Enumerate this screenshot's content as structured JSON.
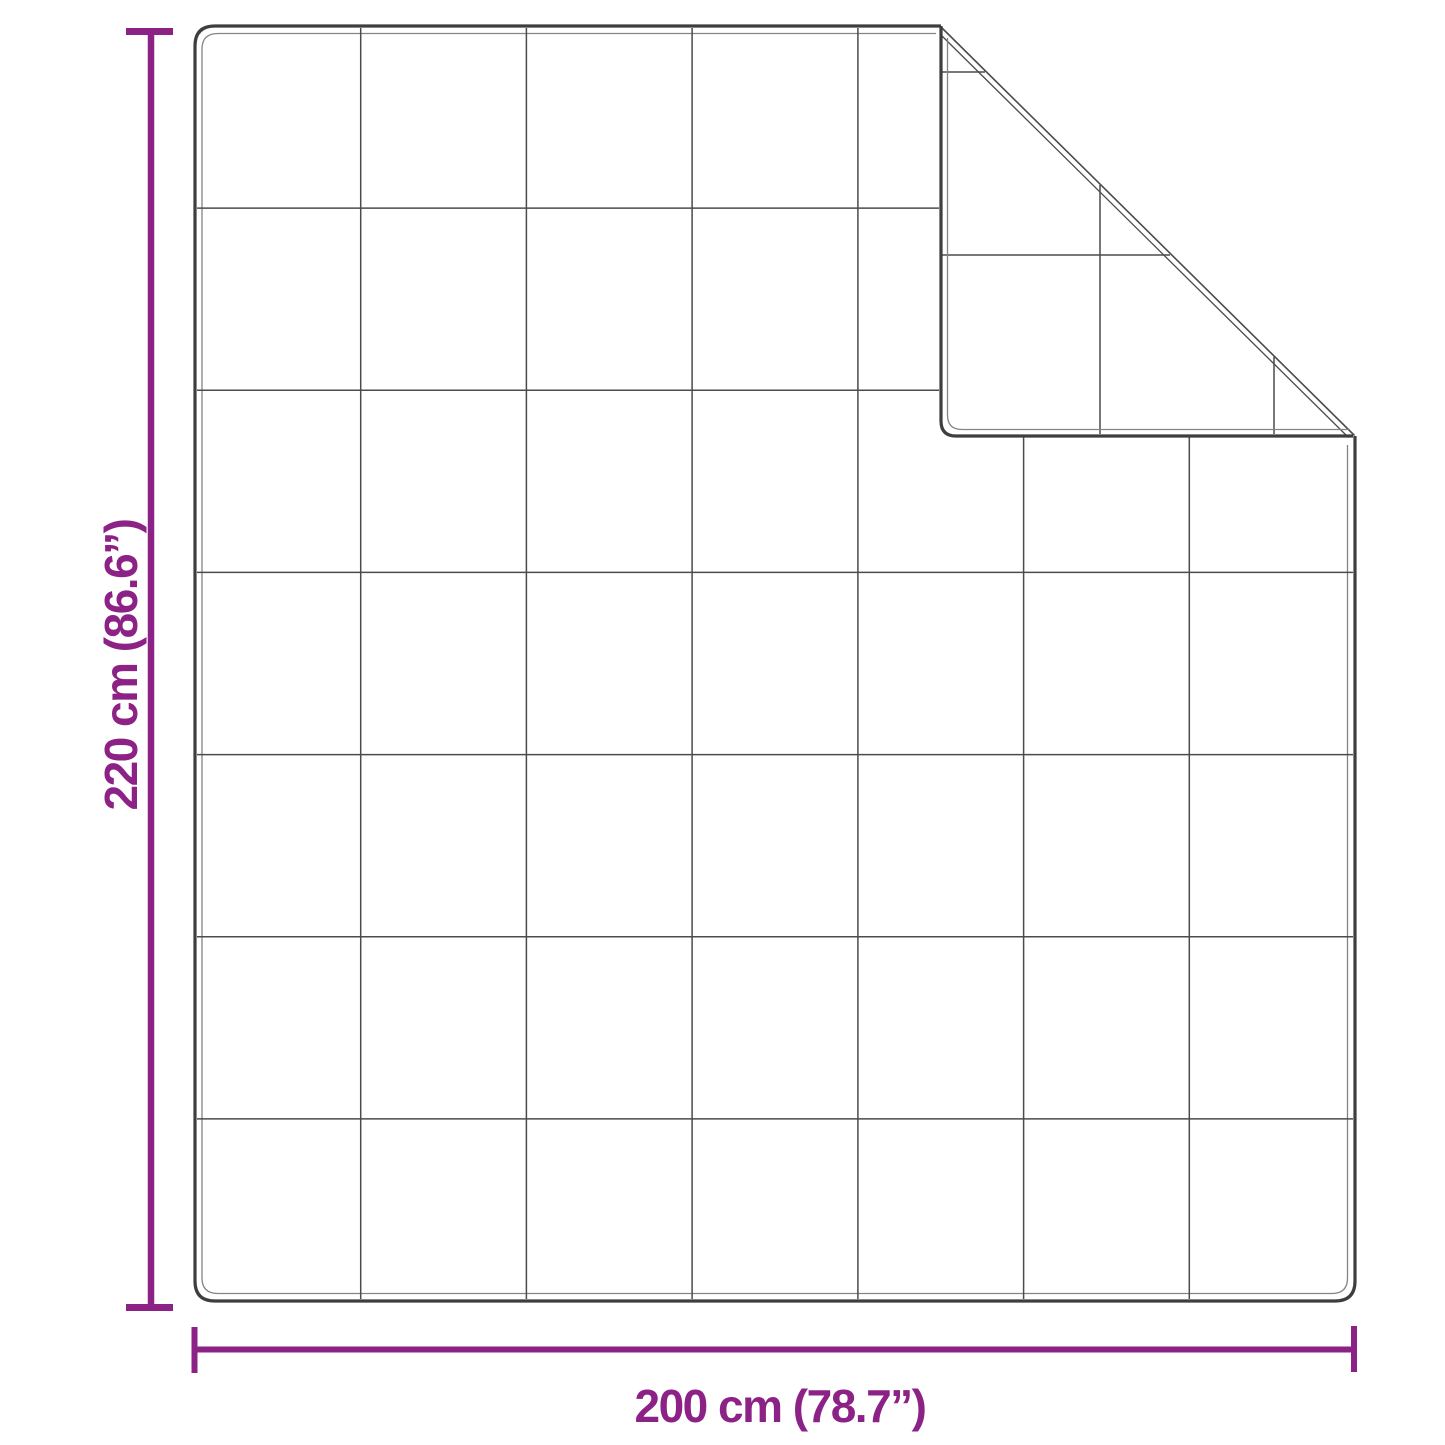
{
  "diagram": {
    "type": "product-dimension-diagram",
    "subject": "quilted blanket with folded top-right corner",
    "vertical_dimension_label": "220 cm (86.6”)",
    "horizontal_dimension_label": "200 cm (78.7”)",
    "grid": {
      "columns": 7,
      "rows": 7
    }
  },
  "colors": {
    "accent": "#8d2286",
    "outline": "#3e3e3e",
    "outline_inner": "#848484",
    "grid_line": "#4b4b4b",
    "background": "#ffffff"
  }
}
